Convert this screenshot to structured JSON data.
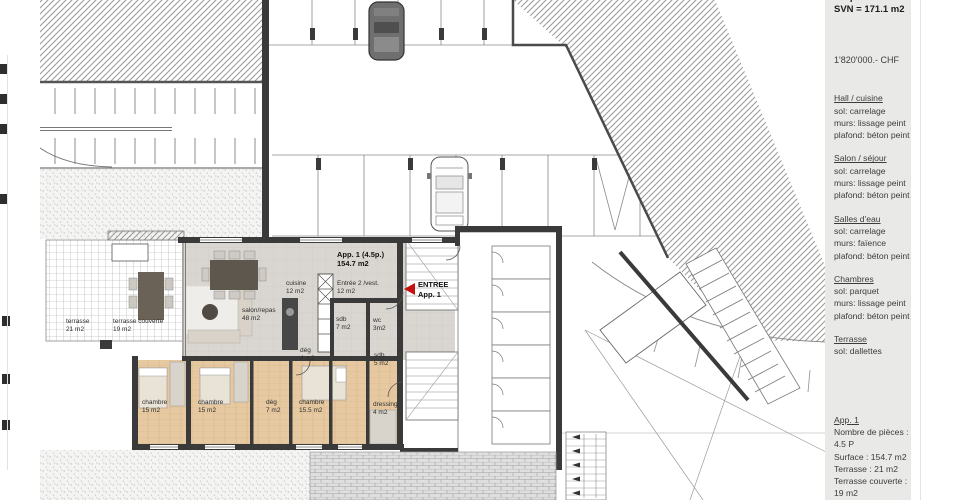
{
  "sidebar": {
    "clipped_top_line": "4.5 pièces",
    "svn_top": "SVN = 171.1 m2",
    "price": "1'820'000.- CHF",
    "sections": [
      {
        "title": "Hall / cuisine",
        "lines": [
          "sol: carrelage",
          "murs: lissage peint",
          "plafond: béton peint"
        ]
      },
      {
        "title": "Salon / séjour",
        "lines": [
          "sol: carrelage",
          "murs: lissage peint",
          "plafond: béton peint"
        ]
      },
      {
        "title": "Salles d'eau",
        "lines": [
          "sol: carrelage",
          "murs: faïence",
          "plafond: béton peint"
        ]
      },
      {
        "title": "Chambres",
        "lines": [
          "sol: parquet",
          "murs: lissage peint",
          "plafond: béton peint"
        ]
      },
      {
        "title": "Terrasse",
        "lines": [
          "sol: dallettes"
        ]
      }
    ],
    "summary": {
      "title": "App. 1",
      "lines": [
        "Nombre de pièces : 4.5 P",
        "Surface : 154.7 m2",
        "Terrasse : 21 m2",
        "Terrasse couverte : 19 m2"
      ],
      "svn": "SVN = 171.1 m2"
    }
  },
  "plan": {
    "entry_marker": {
      "line1": "ENTREE",
      "line2": "App. 1"
    },
    "colors": {
      "wall": "#3a3a3a",
      "wood": "#e6c9a1",
      "tile": "#d9d6d1",
      "accent_red": "#c41212"
    },
    "labels": [
      {
        "name": "label-app-title",
        "x": 337,
        "y": 250,
        "bold": true,
        "size": 7.5,
        "lines": [
          "App. 1 (4.5p.)",
          "154.7 m2"
        ]
      },
      {
        "name": "label-cuisine",
        "x": 286,
        "y": 280,
        "size": 6.5,
        "lines": [
          "cuisine",
          "12 m2"
        ]
      },
      {
        "name": "label-entree2",
        "x": 337,
        "y": 280,
        "size": 6.5,
        "lines": [
          "Entrée 2 /vest.",
          "12 m2"
        ]
      },
      {
        "name": "label-salon",
        "x": 242,
        "y": 307,
        "size": 6.5,
        "lines": [
          "salon/repas",
          "48 m2"
        ]
      },
      {
        "name": "label-sdb7",
        "x": 336,
        "y": 316,
        "size": 6.5,
        "lines": [
          "sdb",
          "7 m2"
        ]
      },
      {
        "name": "label-wc3",
        "x": 373,
        "y": 317,
        "size": 6.5,
        "lines": [
          "wc",
          "3m2"
        ]
      },
      {
        "name": "label-deg4",
        "x": 300,
        "y": 347,
        "size": 6.5,
        "lines": [
          "dég",
          "4 m2"
        ]
      },
      {
        "name": "label-sdb5",
        "x": 374,
        "y": 352,
        "size": 6.5,
        "lines": [
          "sdb",
          "5 m2"
        ]
      },
      {
        "name": "label-chambre-1",
        "x": 142,
        "y": 399,
        "size": 6.5,
        "lines": [
          "chambre",
          "15 m2"
        ]
      },
      {
        "name": "label-chambre-2",
        "x": 198,
        "y": 399,
        "size": 6.5,
        "lines": [
          "chambre",
          "15 m2"
        ]
      },
      {
        "name": "label-deg7",
        "x": 266,
        "y": 399,
        "size": 6.5,
        "lines": [
          "dég",
          "7 m2"
        ]
      },
      {
        "name": "label-chambre-3",
        "x": 299,
        "y": 399,
        "size": 6.5,
        "lines": [
          "chambre",
          "15.5 m2"
        ]
      },
      {
        "name": "label-dressing",
        "x": 373,
        "y": 401,
        "size": 6.5,
        "lines": [
          "dressing",
          "4 m2"
        ]
      },
      {
        "name": "label-terrasse",
        "x": 66,
        "y": 318,
        "size": 6.5,
        "lines": [
          "terrasse",
          "21 m2"
        ]
      },
      {
        "name": "label-terrasse-couverte",
        "x": 113,
        "y": 318,
        "size": 6.5,
        "lines": [
          "terrasse couverte",
          "19 m2"
        ]
      }
    ]
  }
}
